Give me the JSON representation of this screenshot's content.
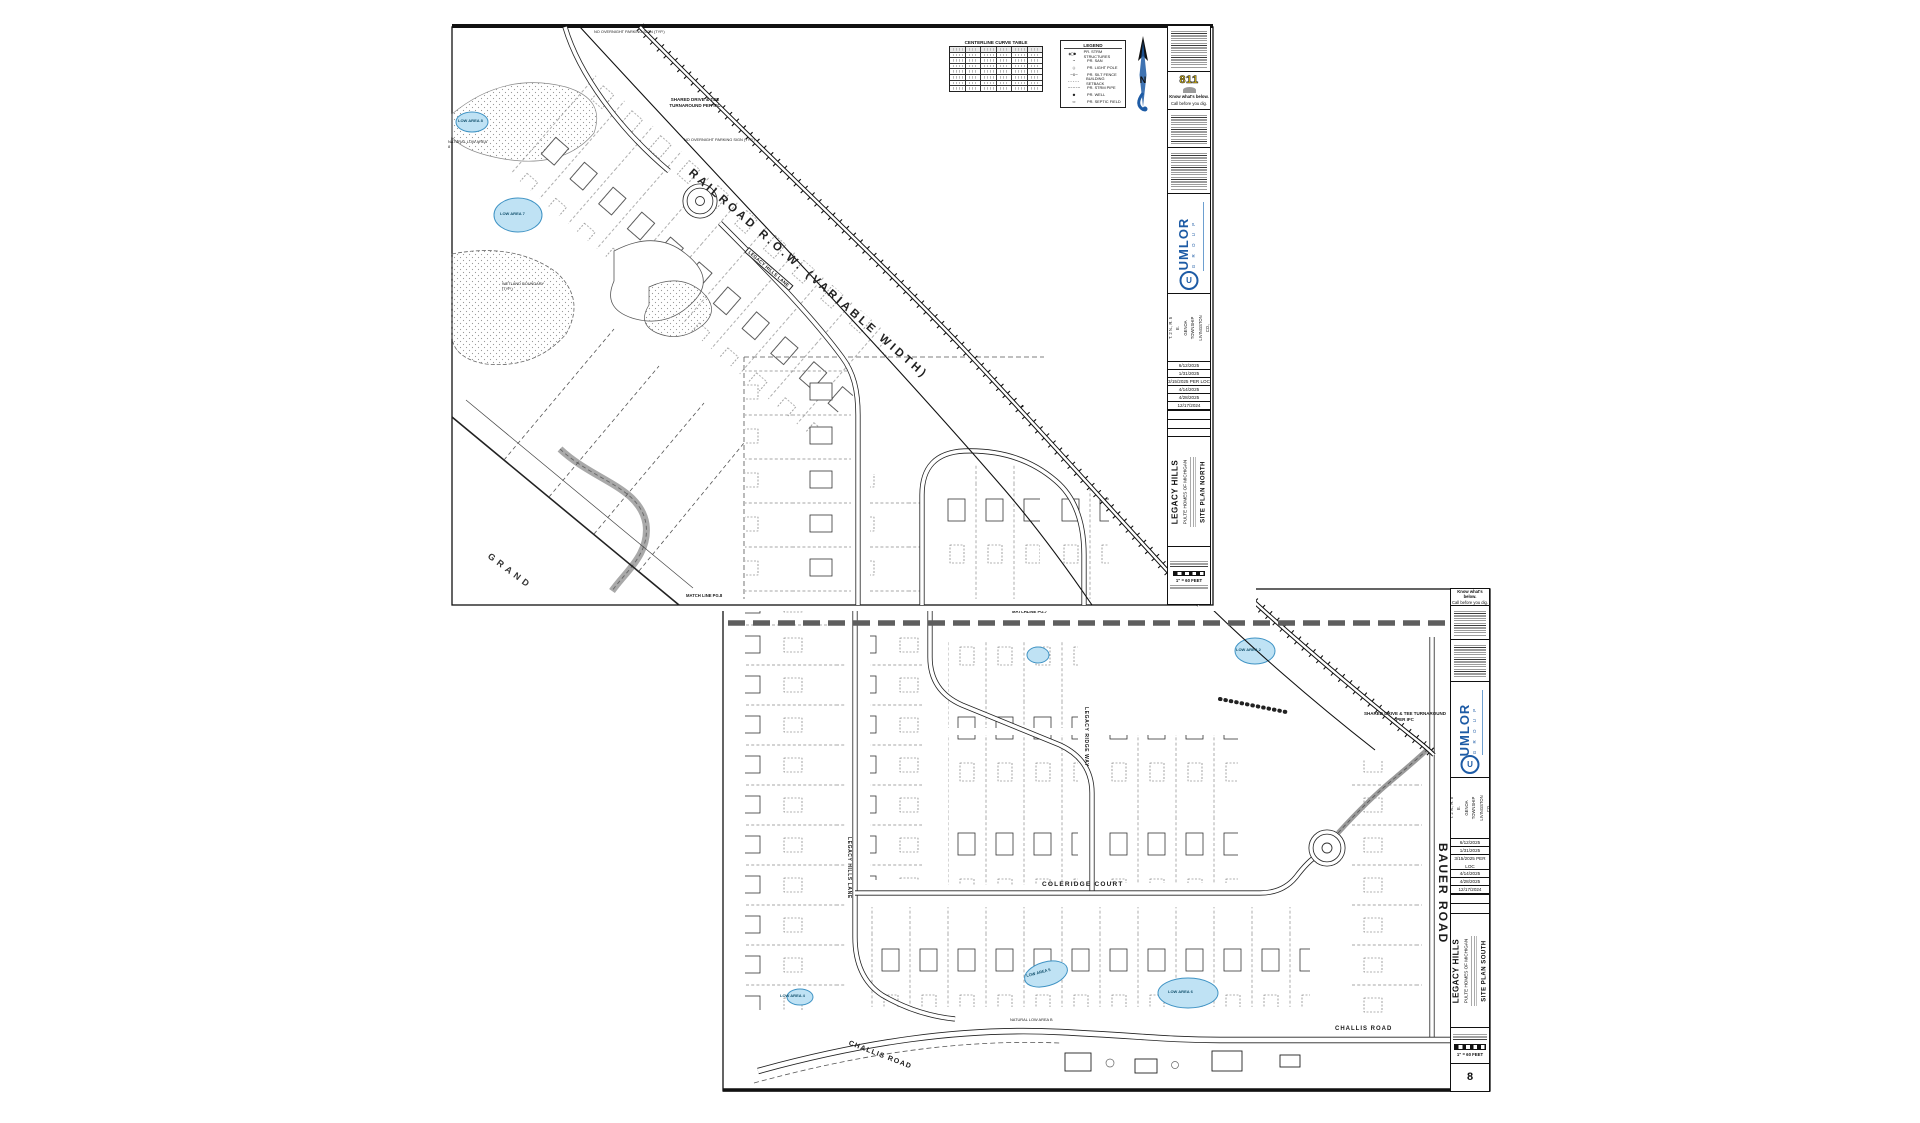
{
  "colors": {
    "umlor_blue": "#1d5ba5",
    "call811_yellow": "#e8c412",
    "pond_fill": "#bfe2f4",
    "pond_stroke": "#3f93c4",
    "matchline_gray": "#5e5e5e"
  },
  "sheet_north": {
    "curve_table": {
      "title": "CENTERLINE CURVE TABLE"
    },
    "legend": {
      "title": "LEGEND",
      "items": [
        {
          "sym": "◉□●",
          "label": "PR. STRM STRUCTURES"
        },
        {
          "sym": "~",
          "label": "PR. SAN"
        },
        {
          "sym": "○",
          "label": "PR. LIGHT POLE"
        },
        {
          "sym": "—x—",
          "label": "PR. SILT FENCE"
        },
        {
          "sym": "-----",
          "label": "BUILDING SETBACK"
        },
        {
          "sym": "–·–·–",
          "label": "PR. STRM PIPE"
        },
        {
          "sym": "●",
          "label": "PR. WELL"
        },
        {
          "sym": "▭",
          "label": "PR. SEPTIC FIELD"
        }
      ]
    },
    "north_label": "N",
    "labels": {
      "railroad": "RAILROAD R.O.W. (VARIABLE WIDTH)",
      "street_box": "LEGACY HILLS LANE",
      "shared_drive": "SHARED DRIVE & TEE TURNAROUND PER IFC",
      "no_parking": "NO OVERNIGHT PARKING SIGN (TYP.)",
      "grand": "GRAND",
      "low7": "LOW AREA 7",
      "low8": "LOW AREA 8",
      "natural_low": "NATURAL LOW AREA 8",
      "wetland": "WETLAND BOUNDARY (TYP.)",
      "match": "MATCH LINE PG.8"
    },
    "strip": {
      "eight11": "811",
      "know": "Know what's below.",
      "call": "Call before you dig.",
      "company": "UMLOR",
      "group": "G R O U P",
      "section": "SECTION 23",
      "trs": "T. 2 N., R. 5 E.",
      "township": "GENOA TOWNSHIP",
      "county": "LIVINGSTON CO., MICHIGAN",
      "revisions": [
        "6/12/2025",
        "1/31/2025",
        "3/15/2025 PER LOC",
        "4/14/2025",
        "4/28/2025",
        "12/17/2024"
      ],
      "project": "LEGACY HILLS",
      "client": "PULTE HOMES OF MICHIGAN",
      "sheet_title": "SITE PLAN NORTH",
      "scale": "1\" = 60 FEET"
    }
  },
  "sheet_south": {
    "labels": {
      "matchline": "MATCHLINE PG.7",
      "legacy_lane": "LEGACY HILLS LANE",
      "ridge_way": "LEGACY RIDGE WAY",
      "coleridge": "COLERIDGE COURT",
      "challis_left": "CHALLIS ROAD",
      "challis_right": "CHALLIS ROAD",
      "bauer": "BAUER ROAD",
      "shared_drive": "SHARED DRIVE & TEE TURNAROUND PER IFC",
      "natural_low": "NATURAL LOW AREA B",
      "low2": "LOW AREA 2",
      "low4": "LOW AREA 4",
      "low5": "LOW AREA 5",
      "low6": "LOW AREA 6"
    },
    "strip": {
      "know": "Know what's below.",
      "call": "Call before you dig.",
      "company": "UMLOR",
      "group": "G R O U P",
      "section": "SECTION 23",
      "trs": "T. 2 N., R. 5 E.",
      "township": "GENOA TOWNSHIP",
      "county": "LIVINGSTON CO., MICHIGAN",
      "revisions": [
        "6/12/2025",
        "1/31/2025",
        "3/15/2025 PER LOC",
        "4/14/2025",
        "4/28/2025",
        "12/17/2024"
      ],
      "project": "LEGACY HILLS",
      "client": "PULTE HOMES OF MICHIGAN",
      "sheet_title": "SITE PLAN SOUTH",
      "scale": "1\" = 60 FEET",
      "sheet_number": "8"
    }
  }
}
